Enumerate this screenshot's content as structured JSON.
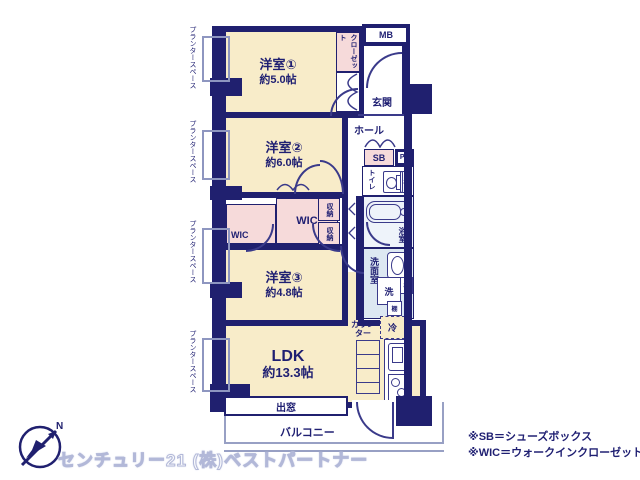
{
  "colors": {
    "wall_navy": "#20206f",
    "room_cream": "#f8ecc9",
    "closet_pink": "#f6dada",
    "washroom_blue": "#dde8f2",
    "bath_blue": "#eef3fa",
    "balcony_line": "#98a0c4"
  },
  "rooms": {
    "r1": {
      "name": "洋室①",
      "size": "約5.0帖"
    },
    "r2": {
      "name": "洋室②",
      "size": "約6.0帖"
    },
    "r3": {
      "name": "洋室③",
      "size": "約4.8帖"
    },
    "ldk": {
      "name": "LDK",
      "size": "約13.3帖"
    }
  },
  "areas": {
    "closet": "クローゼット",
    "mb": "MB",
    "entrance": "玄関",
    "hall": "ホール",
    "shoe_box": "SB",
    "pipe_space": "PS",
    "toilet": "トイレ",
    "shelf": "棚",
    "bath": "浴室",
    "washroom": "洗面室",
    "washer": "洗",
    "fridge": "冷",
    "counter": "カウンター",
    "storage": "収納",
    "wic": "WIC",
    "bay_window": "出窓",
    "balcony": "バルコニー",
    "planter": "プランタースペース"
  },
  "compass": {
    "north": "N"
  },
  "footer": {
    "company": "センチュリー21 (株)ベストパートナー",
    "note_sb": "※SB＝シューズボックス",
    "note_wic": "※WIC＝ウォークインクローゼット"
  }
}
